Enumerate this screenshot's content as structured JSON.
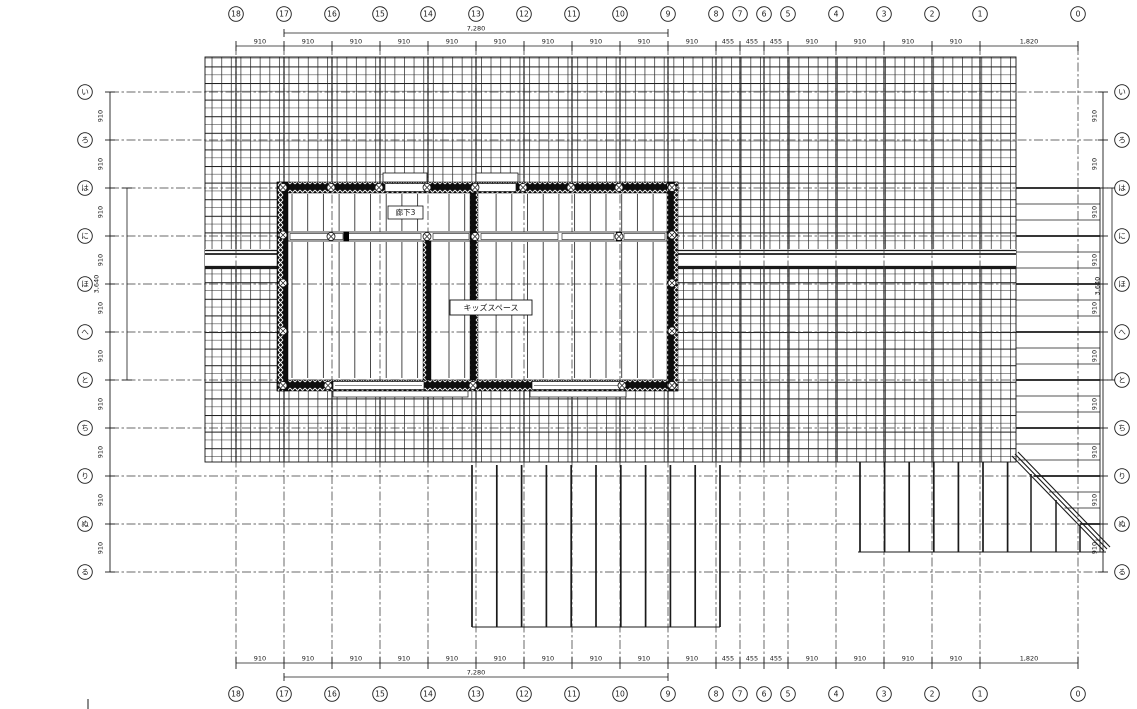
{
  "page": {
    "background": "#ffffff",
    "line_color": "#1a1a1a"
  },
  "plan": {
    "room_labels": [
      {
        "id": "corridor",
        "text": "廊下3"
      },
      {
        "id": "kids-space",
        "text": "キッズスペース"
      }
    ]
  },
  "axes": {
    "columns": {
      "labels": [
        "18",
        "17",
        "16",
        "15",
        "14",
        "13",
        "12",
        "11",
        "10",
        "9",
        "8",
        "7",
        "6",
        "5",
        "4",
        "3",
        "2",
        "1",
        "0"
      ],
      "dims_between": [
        "910",
        "910",
        "910",
        "910",
        "910",
        "910",
        "910",
        "910",
        "910",
        "910",
        "455",
        "455",
        "455",
        "910",
        "910",
        "910",
        "910",
        "1,820"
      ],
      "overall_dim": "7,280",
      "overall_span": [
        "17",
        "9"
      ]
    },
    "rows": {
      "labels": [
        "い",
        "ろ",
        "は",
        "に",
        "ほ",
        "へ",
        "と",
        "ち",
        "り",
        "ぬ",
        "る"
      ],
      "dims_between": [
        "910",
        "910",
        "910",
        "910",
        "910",
        "910",
        "910",
        "910",
        "910",
        "910"
      ],
      "overall_dim": "3,640",
      "overall_span": [
        "は",
        "と"
      ]
    }
  }
}
